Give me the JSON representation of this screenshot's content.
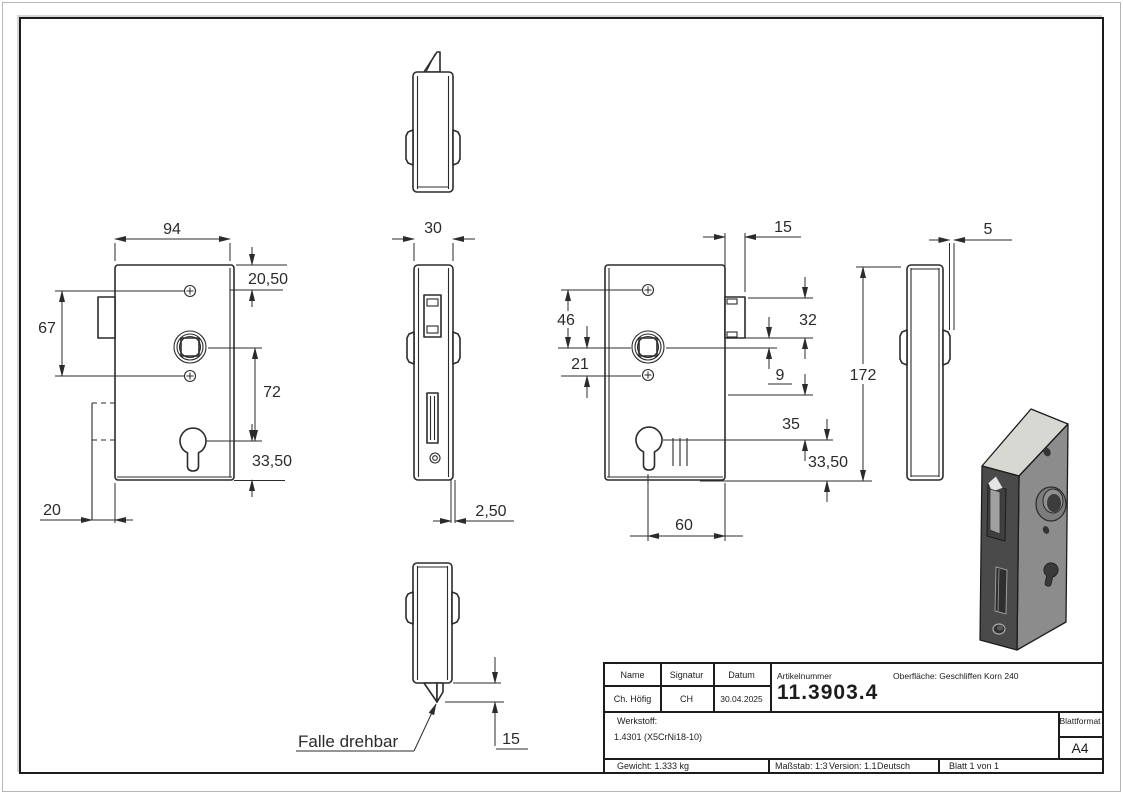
{
  "dims": {
    "front": {
      "width": "94",
      "top_to_screw": "20,50",
      "screw_span": "67",
      "spindle_to_cylinder": "72",
      "cylinder_to_bottom": "33,50",
      "bolt_depth": "20"
    },
    "face": {
      "width": "30",
      "plate_thickness": "2,50"
    },
    "bottom": {
      "latch_protrusion": "15",
      "note": "Falle drehbar"
    },
    "back": {
      "latch_width": "15",
      "screw_to_spindle": "46",
      "spindle_to_screw": "21",
      "latch_height": "32",
      "latch_to_spindle": "9",
      "to_cylinder": "35",
      "cylinder_to_bottom": "33,50",
      "backset": "60"
    },
    "side": {
      "height": "172",
      "plate_thickness": "5"
    }
  },
  "title_block": {
    "name_label": "Name",
    "signatur_label": "Signatur",
    "datum_label": "Datum",
    "name": "Ch. Höfig",
    "signatur": "CH",
    "datum": "30.04.2025",
    "artikel_label": "Artikelnummer",
    "artikelnummer": "11.3903.4",
    "oberflaeche": "Oberfläche:  Geschliffen Korn 240",
    "werkstoff_label": "Werkstoff:",
    "werkstoff": "1.4301 (X5CrNi18-10)",
    "blattformat_label": "Blattformat",
    "blattformat": "A4",
    "gewicht": "Gewicht: 1.333 kg",
    "massstab": "Maßstab: 1:3",
    "version": "Version: 1.1",
    "sprache": "Deutsch",
    "blatt": "Blatt 1 von 1"
  }
}
